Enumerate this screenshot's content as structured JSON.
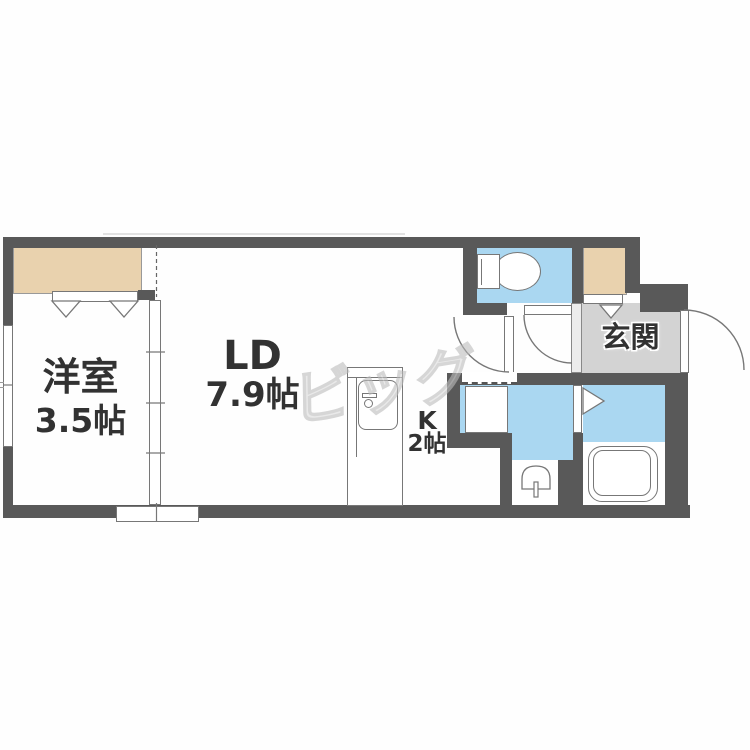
{
  "floorplan": {
    "watermark": "ビッグ",
    "rooms": {
      "western_room": {
        "name": "洋室",
        "size": "3.5帖"
      },
      "living_dining": {
        "name": "LD",
        "size": "7.9帖"
      },
      "kitchen": {
        "name": "K",
        "size": "2帖"
      },
      "entrance": {
        "name": "玄関"
      }
    },
    "colors": {
      "wall": "#595959",
      "wet_area_floor": "#aad7f1",
      "closet_floor": "#e9d2ae",
      "entrance_floor": "#d3d3d3",
      "entrance_step": "#ececec"
    }
  }
}
